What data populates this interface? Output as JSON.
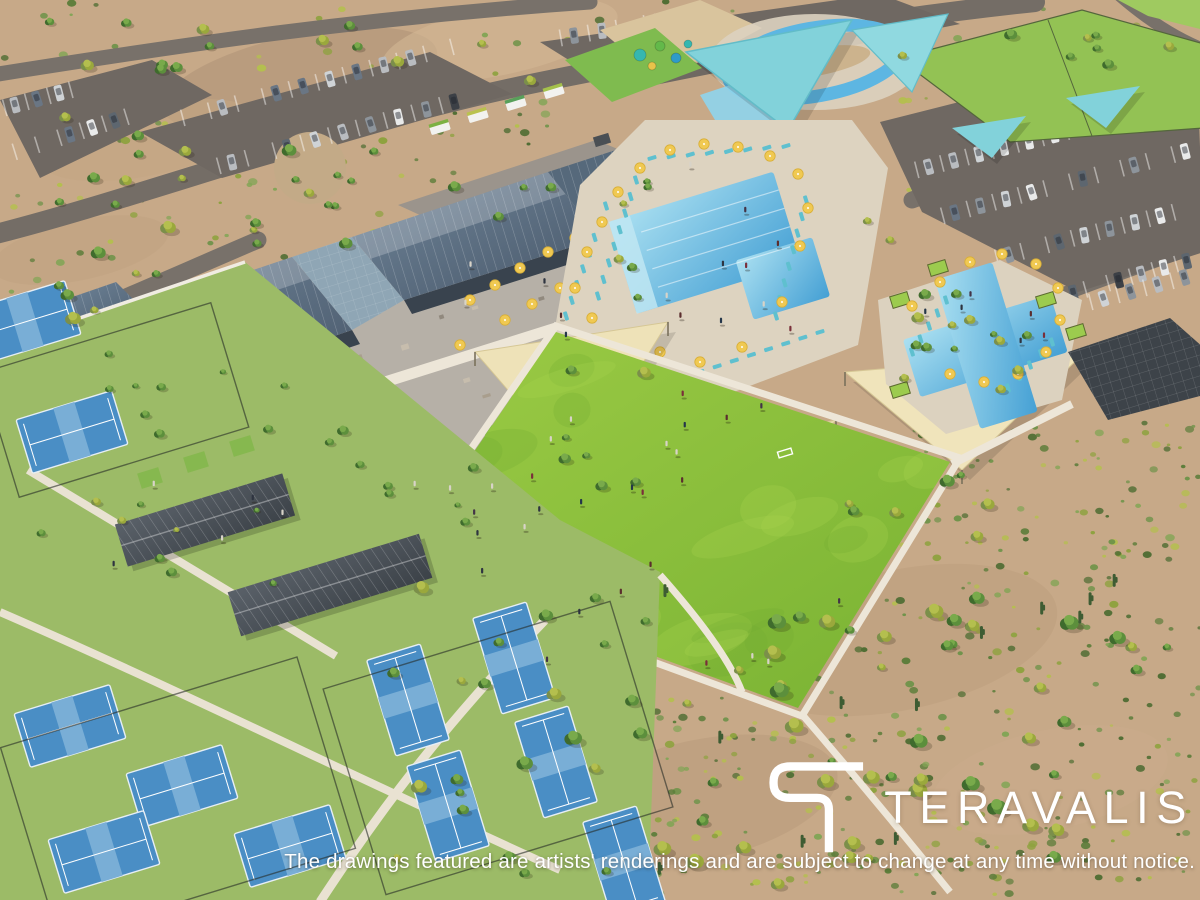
{
  "brand": {
    "logo_text": "TERAVALIS",
    "logo_mark": "teravalis-t-mark"
  },
  "disclaimer": {
    "text": "The drawings featured are artists' renderings and are subject to change at any time without notice."
  },
  "palette": {
    "desert_tan": "#c7a988",
    "lawn_green": "#8bc043",
    "pool_blue": "#5fb4dc",
    "court_blue": "#4a8ec5",
    "roof_slate": "#5b7083",
    "umbrella_yellow": "#f0c952",
    "shade_sail_cream": "#ece0b6",
    "canopy_teal": "#82d2da",
    "asphalt_gray": "#6f6862",
    "path_white": "#ede6d8",
    "logo_white": "#ffffff"
  },
  "scene": {
    "description": "Aerial artist's rendering of a desert community amenity center with clubhouse, resort pools, splash park, playground, event lawn, pickleball courts and parking"
  }
}
